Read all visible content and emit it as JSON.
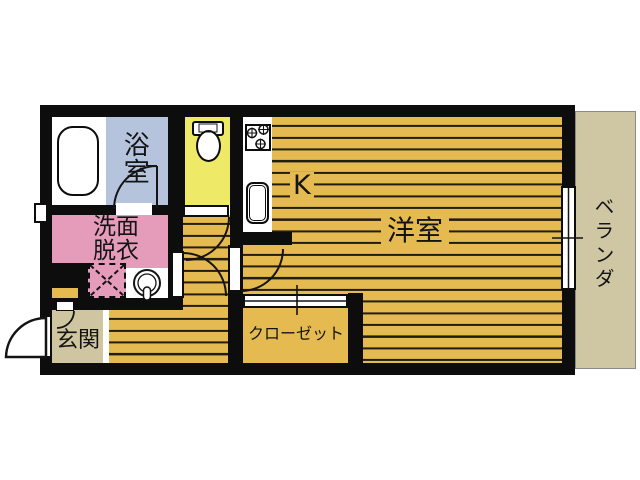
{
  "plan_type": "apartment-floor-plan",
  "labels": {
    "bathroom": "浴室",
    "washroom_line1": "洗面",
    "washroom_line2": "脱衣",
    "kitchen": "K",
    "living_room": "洋室",
    "closet": "クローゼット",
    "entrance": "玄関",
    "veranda": "ベランダ"
  },
  "colors": {
    "floor": "#e5ba50",
    "floorline": "#211d12",
    "wall": "#0d0d0d",
    "bath": "#b5c3dd",
    "toiletroom": "#efe968",
    "washroom": "#e59cba",
    "genkan": "#cfc5a0",
    "veranda": "#cfc6a3",
    "paper": "#ffffff",
    "text": "#141414"
  },
  "fixtures": [
    "bathtub",
    "toilet",
    "gas-stove",
    "kitchen-sink",
    "wash-basin",
    "washing-machine-pan",
    "shoe-cabinet",
    "entrance-door",
    "bathroom-door",
    "toilet-door",
    "washroom-door",
    "living-room-door",
    "closet-sliding-door",
    "balcony-sliding-window",
    "wall-window"
  ]
}
